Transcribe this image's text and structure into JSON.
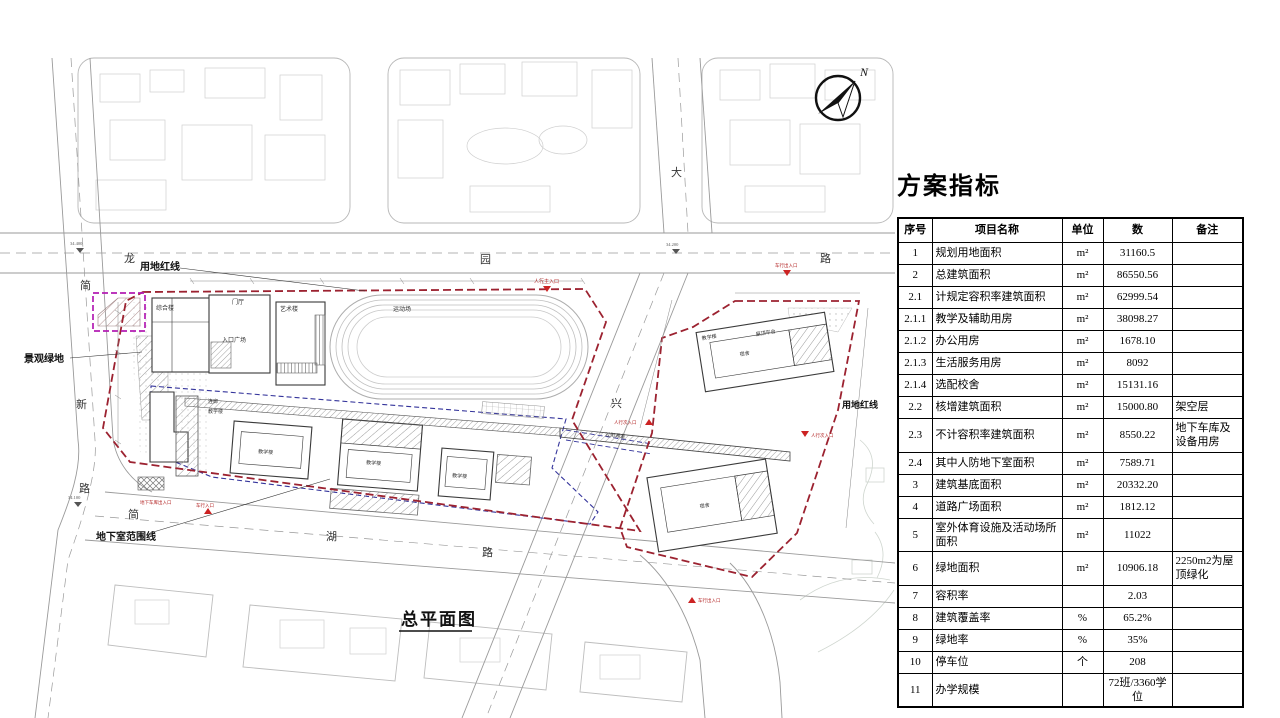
{
  "panel": {
    "title": "方案指标",
    "table": {
      "headers": [
        "序号",
        "项目名称",
        "单位",
        "数",
        "备注"
      ],
      "rows": [
        [
          "1",
          "规划用地面积",
          "m²",
          "31160.5",
          ""
        ],
        [
          "2",
          "总建筑面积",
          "m²",
          "86550.56",
          ""
        ],
        [
          "2.1",
          "计规定容积率建筑面积",
          "m²",
          "62999.54",
          ""
        ],
        [
          "2.1.1",
          "教学及辅助用房",
          "m²",
          "38098.27",
          ""
        ],
        [
          "2.1.2",
          "办公用房",
          "m²",
          "1678.10",
          ""
        ],
        [
          "2.1.3",
          "生活服务用房",
          "m²",
          "8092",
          ""
        ],
        [
          "2.1.4",
          "选配校舍",
          "m²",
          "15131.16",
          ""
        ],
        [
          "2.2",
          "核增建筑面积",
          "m²",
          "15000.80",
          "架空层"
        ],
        [
          "2.3",
          "不计容积率建筑面积",
          "m²",
          "8550.22",
          "地下车库及设备用房"
        ],
        [
          "2.4",
          "其中人防地下室面积",
          "m²",
          "7589.71",
          ""
        ],
        [
          "3",
          "建筑基底面积",
          "m²",
          "20332.20",
          ""
        ],
        [
          "4",
          "道路广场面积",
          "m²",
          "1812.12",
          ""
        ],
        [
          "5",
          "室外体育设施及活动场所面积",
          "m²",
          "11022",
          ""
        ],
        [
          "6",
          "绿地面积",
          "m²",
          "10906.18",
          "2250m2为屋顶绿化"
        ],
        [
          "7",
          "容积率",
          "",
          "2.03",
          ""
        ],
        [
          "8",
          "建筑覆盖率",
          "%",
          "65.2%",
          ""
        ],
        [
          "9",
          "绿地率",
          "%",
          "35%",
          ""
        ],
        [
          "10",
          "停车位",
          "个",
          "208",
          ""
        ],
        [
          "11",
          "办学规模",
          "",
          "72班/3360学位",
          ""
        ]
      ]
    }
  },
  "plan": {
    "title": "总平面图",
    "labels": {
      "red_line": "用地红线",
      "green_space": "景观绿地",
      "basement_line": "地下室范围线",
      "main_entrance": "人行主入口",
      "side_entrance": "人行次入口",
      "vehicle_entrance": "车行入口",
      "vehicle_exit": "车行出入口",
      "garage_entrance": "地下车库出入口",
      "crossing": "过街通道",
      "corridor": "连廊",
      "sports_field": "运动场",
      "entry_plaza": "入口广场",
      "entry_hall": "门厅",
      "bldg_complex": "综合楼",
      "bldg_art": "艺术楼",
      "bldg_teaching": "教学楼",
      "bldg_dorm": "宿舍",
      "roof_terrace": "屋顶平台",
      "north": "N"
    },
    "roads": {
      "top": [
        "龙",
        "园",
        "路"
      ],
      "middle": [
        "大",
        "兴"
      ],
      "left": [
        "简",
        "新",
        "路"
      ],
      "bottom": [
        "简",
        "湖",
        "路"
      ]
    },
    "elevations": [
      "34.400",
      "34.200",
      "34.100"
    ]
  }
}
